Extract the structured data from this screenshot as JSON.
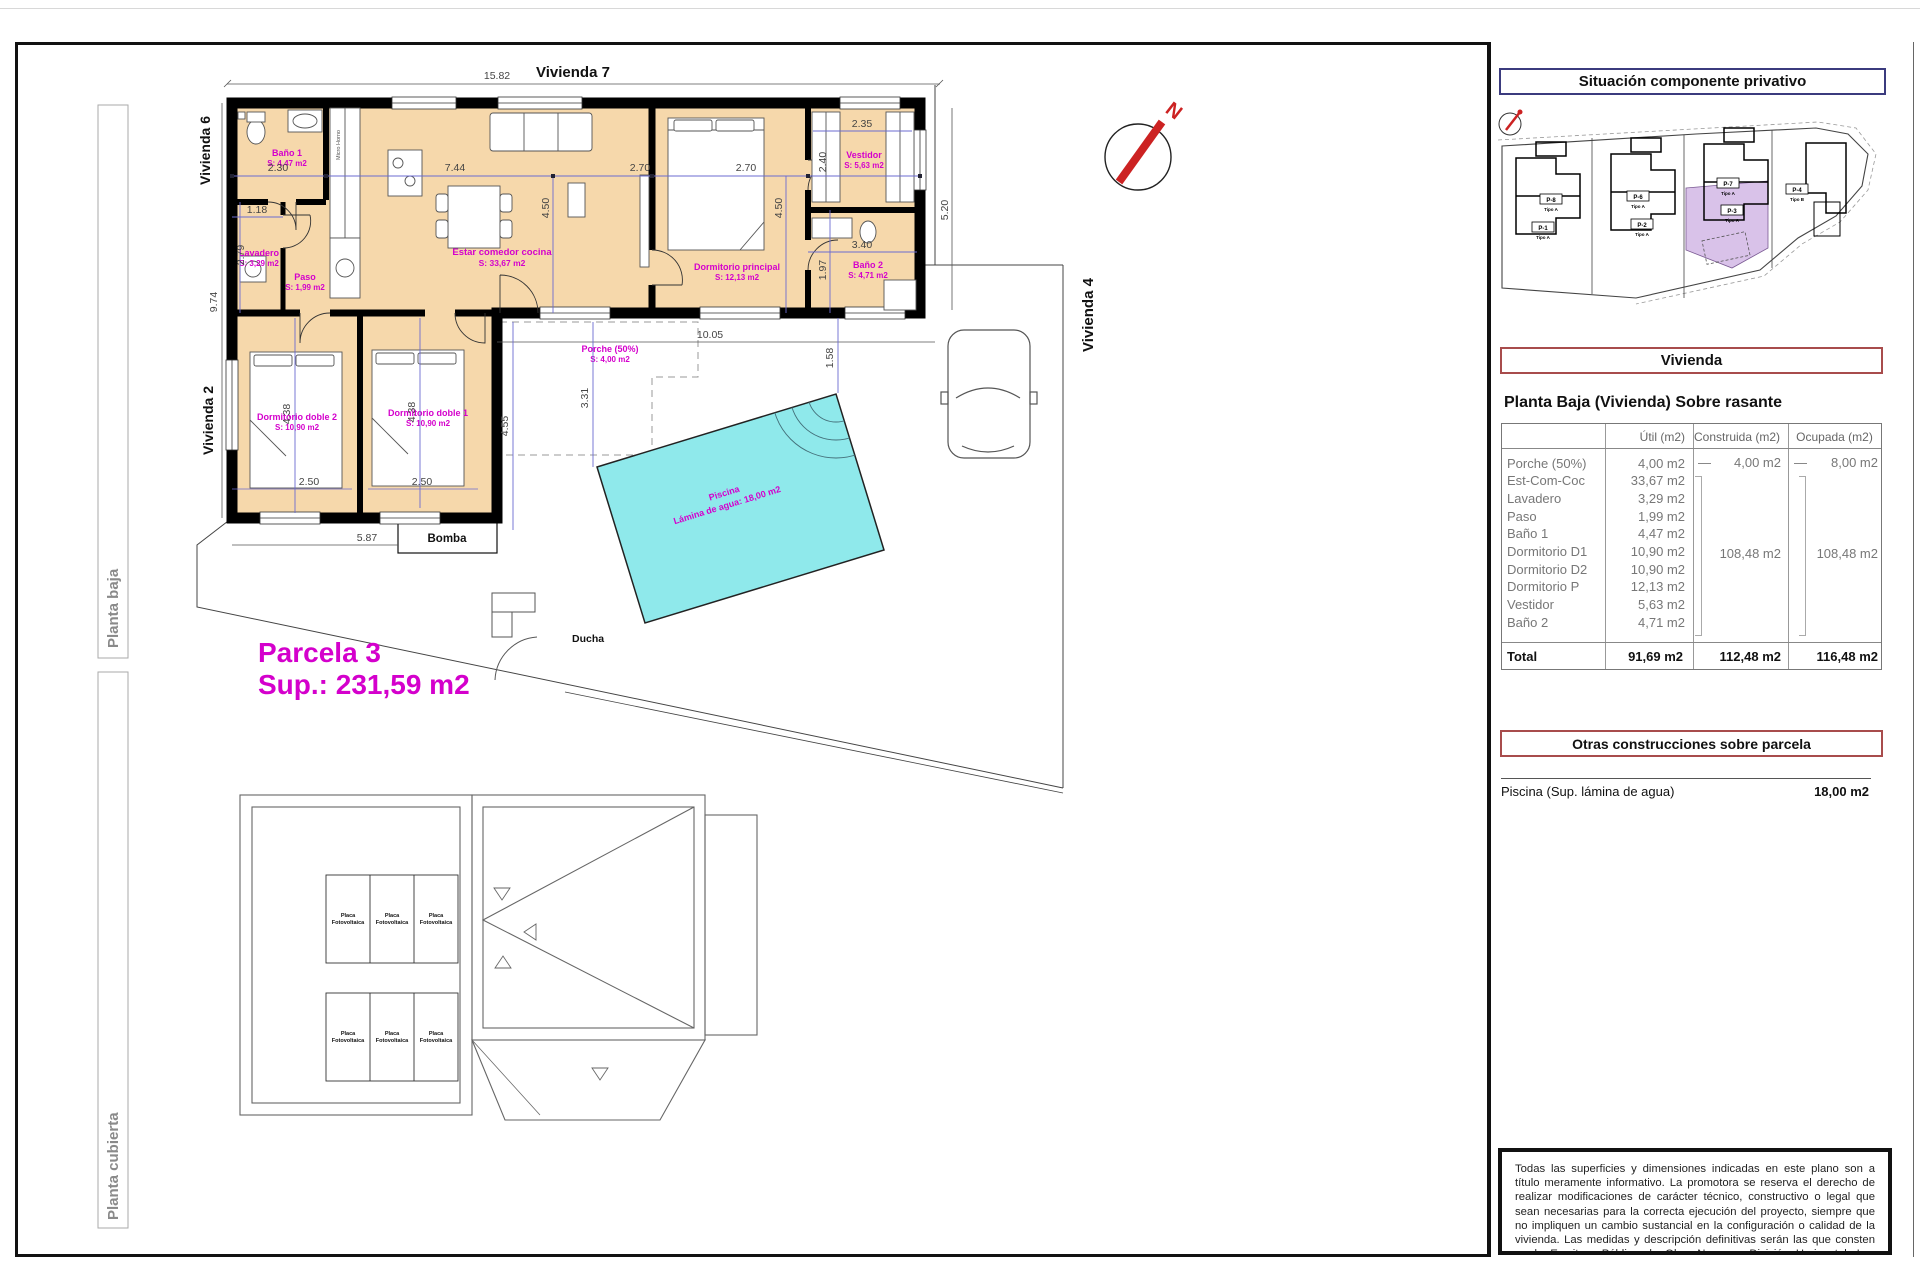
{
  "frame": {
    "planta_baja_label": "Planta baja",
    "planta_cubierta_label": "Planta cubierta"
  },
  "plan": {
    "neighbor_top": "Vivienda 7",
    "neighbor_left_upper": "Vivienda 6",
    "neighbor_left_lower": "Vivienda 2",
    "neighbor_right": "Vivienda 4",
    "compass_letter": "N",
    "parcela_title": "Parcela 3",
    "parcela_sup": "Sup.: 231,59 m2",
    "bomba_label": "Bomba",
    "ducha_label": "Ducha",
    "micro_label": "Micro Horno",
    "rooms": {
      "bano1": {
        "name": "Baño 1",
        "area": "S: 4,47 m2"
      },
      "lavadero": {
        "name": "Lavadero",
        "area": "S: 3,29 m2"
      },
      "paso": {
        "name": "Paso",
        "area": "S: 1,99 m2"
      },
      "estar": {
        "name": "Estar comedor cocina",
        "area": "S: 33,67 m2"
      },
      "dormP": {
        "name": "Dormitorio principal",
        "area": "S: 12,13 m2"
      },
      "vestidor": {
        "name": "Vestidor",
        "area": "S: 5,63 m2"
      },
      "bano2": {
        "name": "Baño 2",
        "area": "S: 4,71 m2"
      },
      "dormD2": {
        "name": "Dormitorio doble 2",
        "area": "S: 10,90 m2"
      },
      "dormD1": {
        "name": "Dormitorio doble 1",
        "area": "S: 10,90 m2"
      },
      "porche": {
        "name": "Porche (50%)",
        "area": "S: 4,00 m2"
      },
      "piscina": {
        "name": "Piscina",
        "area": "Lámina de agua: 18,00 m2"
      }
    },
    "dims": {
      "top_width": "15.82",
      "bano1_w": "2.30",
      "estar_w": "7.44",
      "dorm_w": "2.70",
      "dorm_w2": "2.70",
      "vest_w": "2.35",
      "vest_h": "2.40",
      "estar_h": "4.50",
      "dorm_h": "4.50",
      "right_h": "5.20",
      "lav_w": "1.18",
      "lav_h": "2.79",
      "left_h": "9.74",
      "bano2_w": "3.40",
      "bano2_h": "1.97",
      "porche_w": "10.05",
      "porche_hr": "1.58",
      "d2_h": "4.38",
      "d1_h": "4.38",
      "d2_w": "2.50",
      "d1_w": "2.50",
      "bottom_w": "5.87",
      "porche_h": "4.55",
      "porche_h2": "3.31"
    }
  },
  "roof": {
    "placa1": "Placa",
    "placa2": "Fotovoltaica"
  },
  "sidebar": {
    "situacion_title": "Situación componente privativo",
    "siteplan": {
      "parcels": [
        {
          "id": "P-8",
          "tipo": "Tipo A"
        },
        {
          "id": "P-1",
          "tipo": "Tipo A"
        },
        {
          "id": "P-6",
          "tipo": "Tipo A"
        },
        {
          "id": "P-2",
          "tipo": "Tipo A"
        },
        {
          "id": "P-7",
          "tipo": "Tipo A"
        },
        {
          "id": "P-3",
          "tipo": "Tipo A"
        },
        {
          "id": "P-4",
          "tipo": "Tipo B"
        }
      ]
    },
    "vivienda_title": "Vivienda",
    "planta_heading": "Planta Baja (Vivienda) Sobre rasante",
    "table": {
      "col_util": "Útil (m2)",
      "col_construida": "Construida (m2)",
      "col_ocupada": "Ocupada (m2)",
      "rows": [
        {
          "name": "Porche (50%)",
          "util": "4,00 m2",
          "dash": "—",
          "construida": "4,00 m2",
          "dash2": "—",
          "ocupada": "8,00 m2"
        },
        {
          "name": "Est-Com-Coc",
          "util": "33,67 m2"
        },
        {
          "name": "Lavadero",
          "util": "3,29 m2"
        },
        {
          "name": "Paso",
          "util": "1,99 m2"
        },
        {
          "name": "Baño 1",
          "util": "4,47 m2"
        },
        {
          "name": "Dormitorio D1",
          "util": "10,90 m2"
        },
        {
          "name": "Dormitorio D2",
          "util": "10,90 m2"
        },
        {
          "name": "Dormitorio P",
          "util": "12,13 m2"
        },
        {
          "name": "Vestidor",
          "util": "5,63 m2"
        },
        {
          "name": "Baño 2",
          "util": "4,71 m2"
        }
      ],
      "group_construida": "108,48 m2",
      "group_ocupada": "108,48 m2",
      "total_label": "Total",
      "total_util": "91,69 m2",
      "total_construida": "112,48 m2",
      "total_ocupada": "116,48 m2"
    },
    "otras_title": "Otras construcciones sobre parcela",
    "piscina_label": "Piscina (Sup. lámina de agua)",
    "piscina_value": "18,00 m2",
    "disclaimer": "Todas las superficies y dimensiones indicadas en este plano son a título meramente informativo. La promotora se reserva el derecho de realizar modificaciones de carácter técnico, constructivo o legal que sean necesarias para la correcta ejecución del proyecto, siempre que no impliquen un cambio sustancial en la configuración o calidad de la vivienda. Las medidas y descripción definitivas serán las que consten en la Escritura Pública de Obra Nueva y División Horizontal. Los elementos de mobiliario y decoración son ilustrativos y no están incluidos."
  },
  "colors": {
    "room_fill": "#f6d8ab",
    "pool_fill": "#8fe9eb",
    "magenta": "#d400cc",
    "red_accent": "#cc2222",
    "navy_border": "#3b3b7e",
    "maroon_border": "#a84c4c",
    "highlight_parcel": "#d9c2e9"
  }
}
